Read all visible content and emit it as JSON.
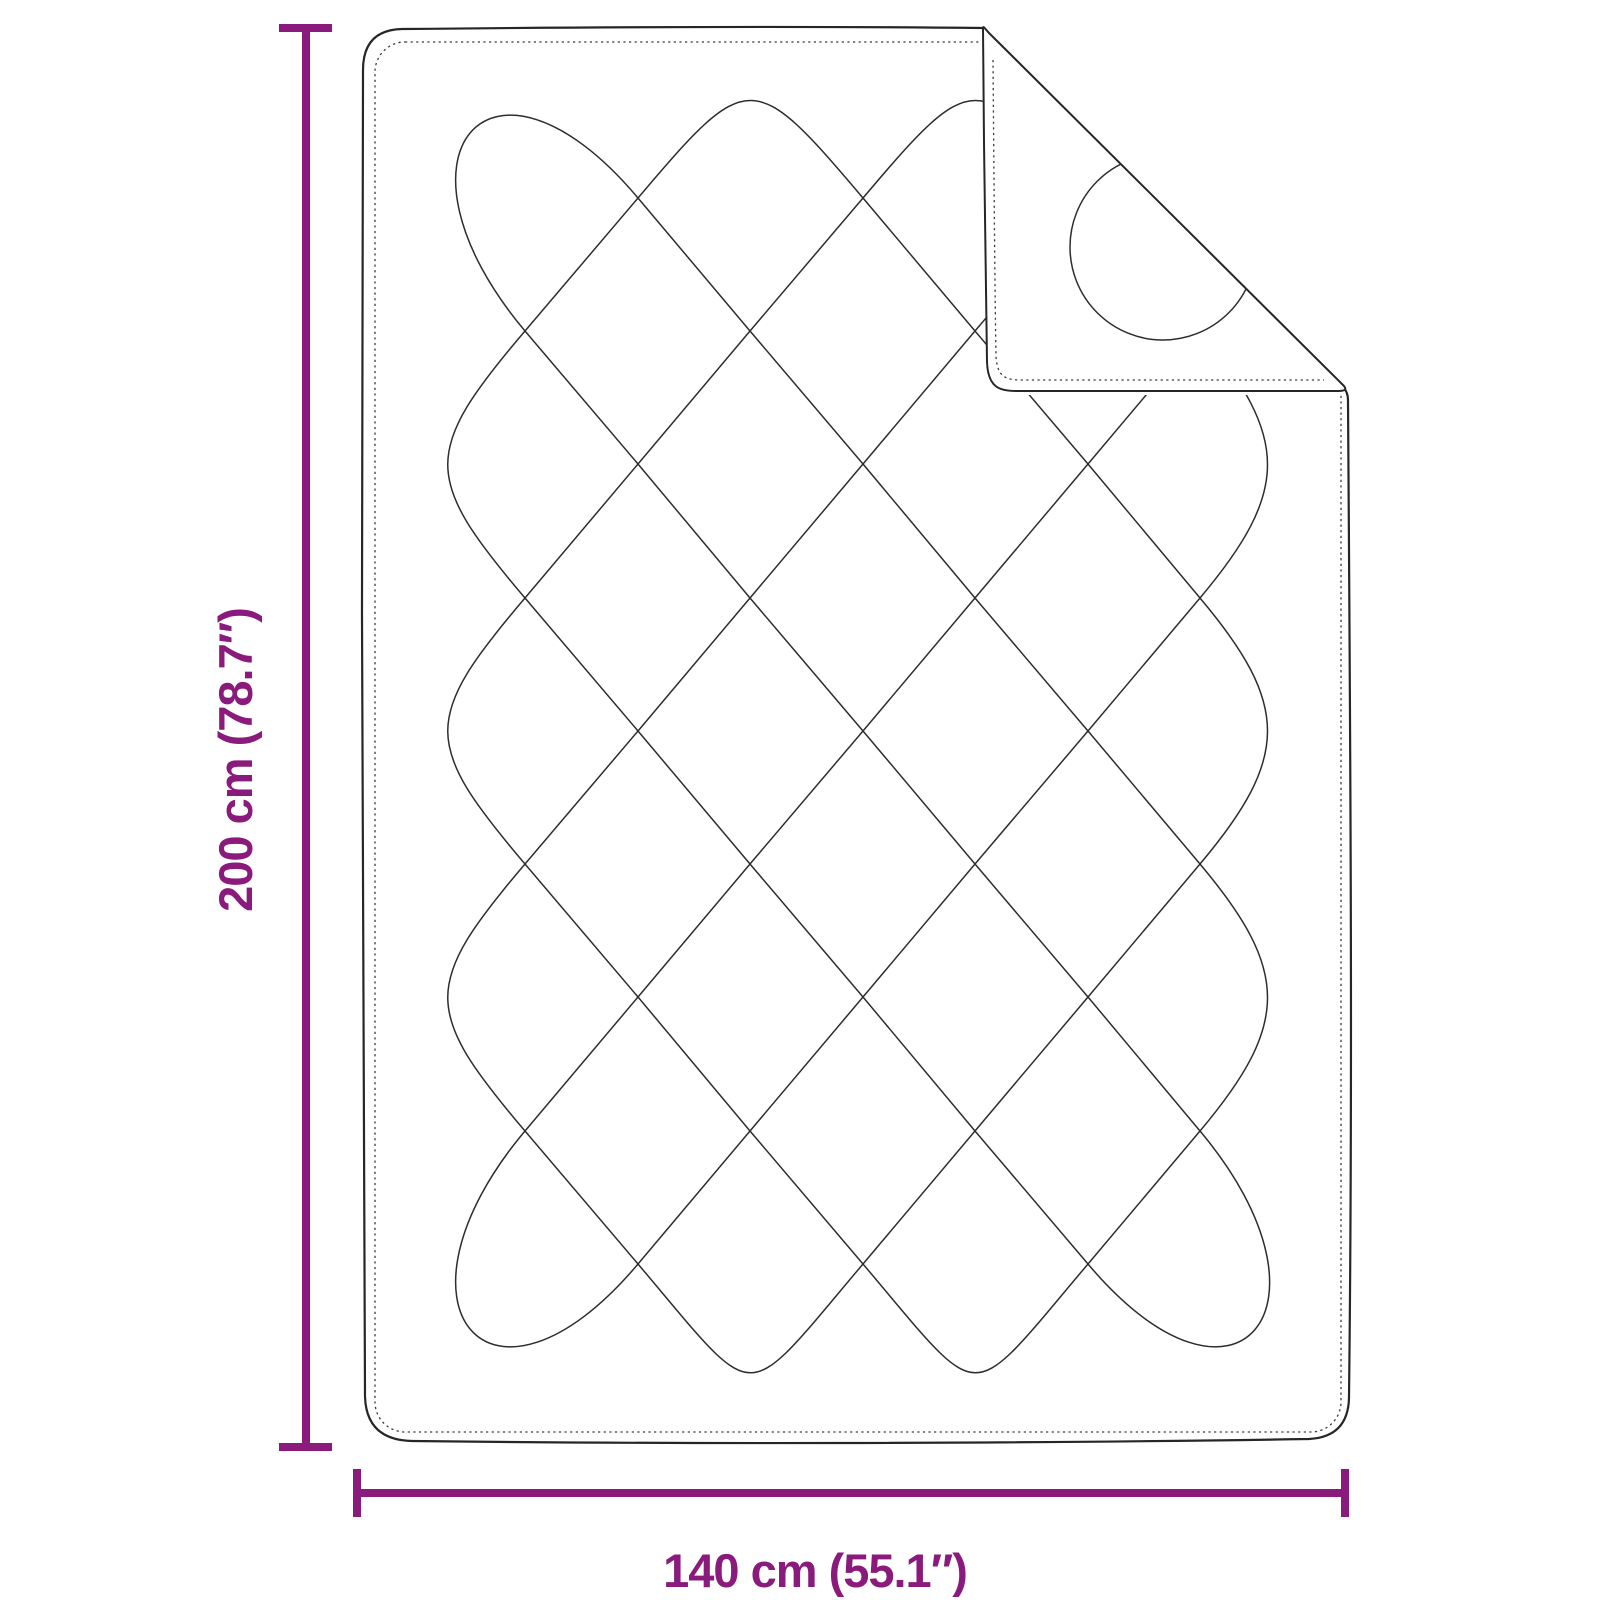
{
  "diagram": {
    "subject": "quilted-blanket-with-folded-corner",
    "height_label": "200 cm (78.7″)",
    "width_label": "140 cm (55.1″)",
    "height_value_cm": "200",
    "height_value_in": "78.7",
    "width_value_cm": "140",
    "width_value_in": "55.1",
    "colors": {
      "dimension_accent": "#8A1A7C",
      "drawing_line": "#2d2d2d",
      "outline": "#262626",
      "background": "#ffffff"
    }
  }
}
